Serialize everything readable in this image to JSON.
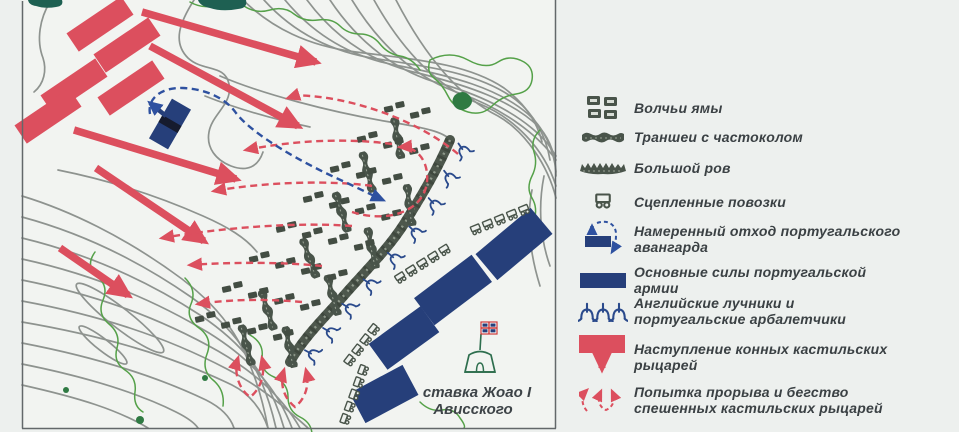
{
  "map": {
    "caption": {
      "line1": "ставка Жоао I",
      "line2": "Ависского"
    }
  },
  "legend": {
    "items": [
      {
        "icon": "wolf-pits-icon",
        "label": "Волчьи ямы"
      },
      {
        "icon": "trench-palisade-icon",
        "label": "Траншеи с частоколом"
      },
      {
        "icon": "big-ditch-icon",
        "label": "Большой ров"
      },
      {
        "icon": "linked-wagons-icon",
        "label": "Сцепленные повозки"
      },
      {
        "icon": "vanguard-withdrawal-icon",
        "label": "Намеренный отход португальского авангарда"
      },
      {
        "icon": "main-forces-icon",
        "label": "Основные силы португальской армии"
      },
      {
        "icon": "archers-crossbowmen-icon",
        "label": "Английские лучники и португальские арбалетчики"
      },
      {
        "icon": "knights-advance-icon",
        "label": "Наступление конных кастильских рыцарей"
      },
      {
        "icon": "breakthrough-flight-icon",
        "label": "Попытка прорыва и бегство спешенных кастильских рыцарей"
      }
    ]
  },
  "colors": {
    "castilian_red": "#dc4f5e",
    "portuguese_navy": "#263f7a",
    "retreat_blue": "#2e51a0",
    "earthwork_dark": "#49544a",
    "contour_gray": "#8e938f",
    "vegetation_green": "#55a149",
    "forest_teal": "#1e6052",
    "paper": "#f2f4f1"
  }
}
